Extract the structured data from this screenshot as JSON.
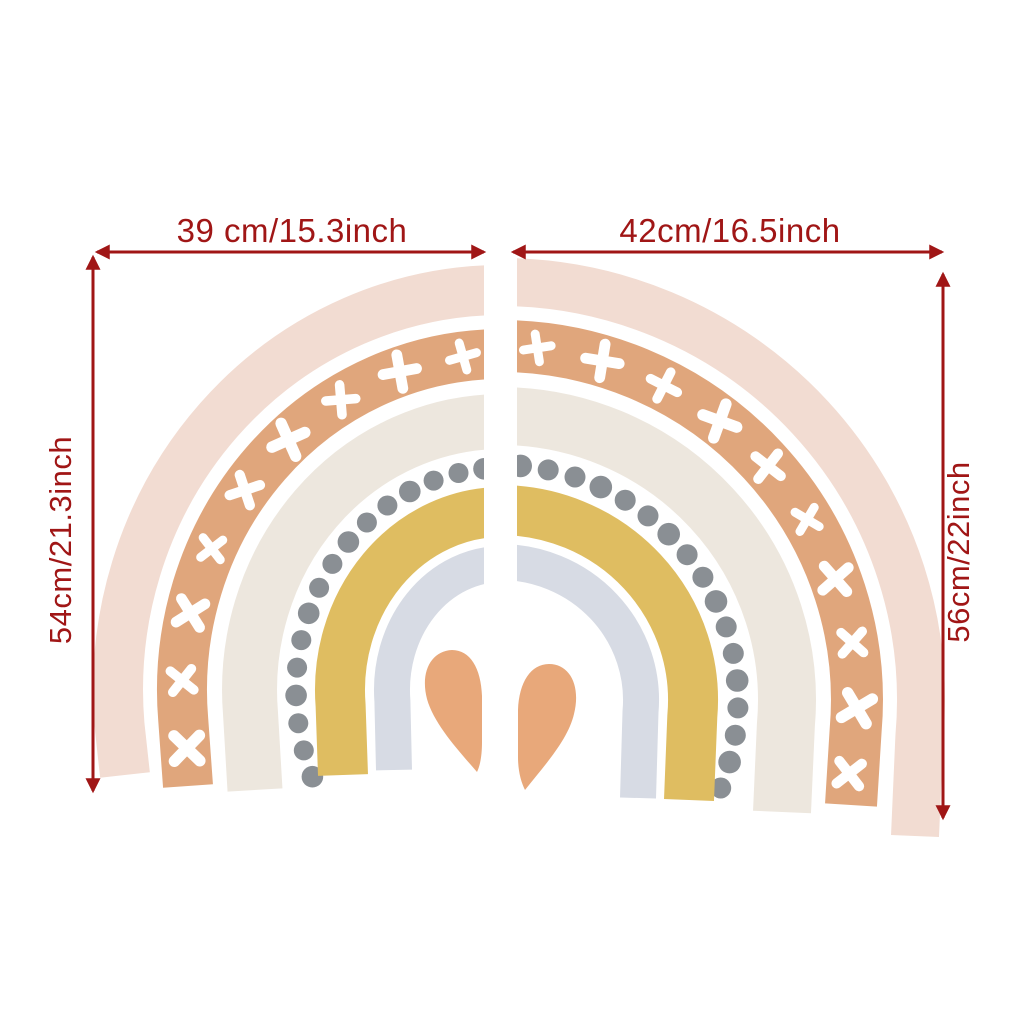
{
  "page": {
    "background": "#ffffff"
  },
  "colors": {
    "annotation_red": "#A01616",
    "band_pink": "#F2DCD2",
    "band_terracotta": "#E0A67C",
    "band_cream": "#EDE7DE",
    "dot_gray": "#8A8F94",
    "band_mustard": "#DFBD61",
    "band_blue": "#D7DBE4",
    "heart": "#E8A87A",
    "cross_white": "#FFFFFF"
  },
  "dimensions": {
    "top_left_width": "39 cm/15.3inch",
    "top_right_width": "42cm/16.5inch",
    "left_height": "54cm/21.3inch",
    "right_height": "56cm/22inch"
  },
  "figure": {
    "type": "product-dimension-diagram",
    "subject": "two-piece boho rainbow wall decal split down the middle",
    "left_half": {
      "width_label": "39 cm/15.3inch",
      "height_label": "54cm/21.3inch",
      "bands_outer_to_inner": [
        "blush pink",
        "terracotta with white crosses",
        "cream",
        "gray dotted arc",
        "mustard yellow",
        "pale blue-gray"
      ],
      "center": "left half of terracotta heart"
    },
    "right_half": {
      "width_label": "42cm/16.5inch",
      "height_label": "56cm/22inch",
      "bands_outer_to_inner": [
        "blush pink",
        "terracotta with white crosses",
        "cream",
        "gray dotted arc",
        "mustard yellow",
        "pale blue-gray"
      ],
      "center": "right half of terracotta heart"
    }
  }
}
